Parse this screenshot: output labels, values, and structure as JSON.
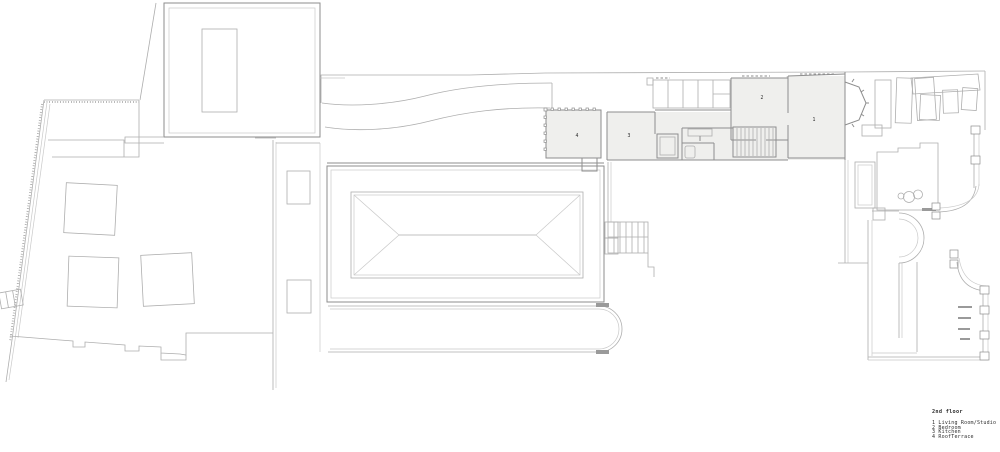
{
  "drawing": {
    "title": "2nd floor plan",
    "legend": {
      "title": "2nd floor",
      "items": [
        "1 Living Room/Studio",
        "2 Bedroom",
        "3 Kitchen",
        "4 RoofTerrace"
      ]
    },
    "rooms": {
      "living_room_studio": {
        "num": "1",
        "name": "Living Room/Studio"
      },
      "bedroom": {
        "num": "2",
        "name": "Bedroom"
      },
      "kitchen": {
        "num": "3",
        "name": "Kitchen"
      },
      "roof_terrace": {
        "num": "4",
        "name": "RoofTerrace"
      }
    }
  },
  "colors": {
    "paper": "#ffffff",
    "line": "#aeaeae",
    "line-dark": "#8e8e8e",
    "line-faint": "#c9c9c9",
    "room-fill": "#efefed",
    "ink": "#2b2b2b",
    "tick": "#9a9a9a"
  }
}
